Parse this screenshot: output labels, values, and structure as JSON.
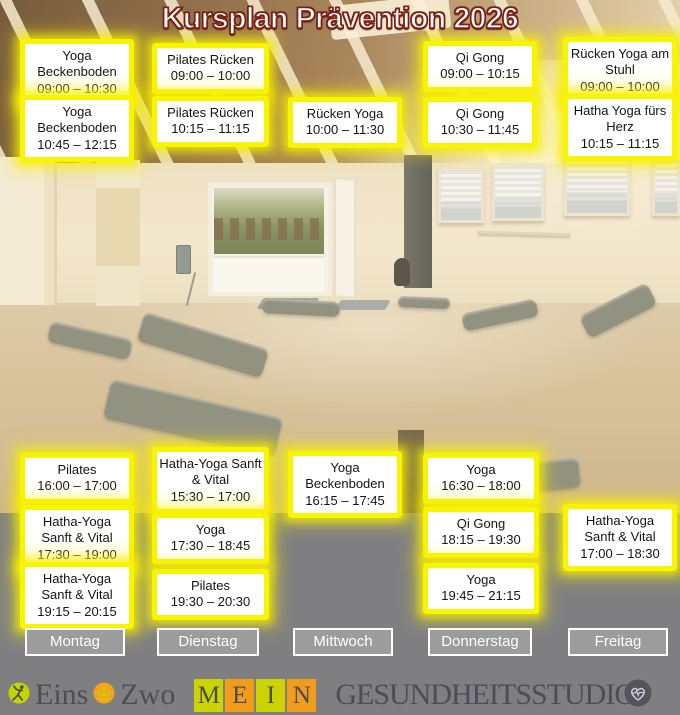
{
  "title": "Kursplan Prävention 2026",
  "days": [
    {
      "label": "Montag",
      "morning": [
        {
          "name": "Yoga Beckenboden",
          "time": "09:00 – 10:30"
        },
        {
          "name": "Yoga Beckenboden",
          "time": "10:45 – 12:15"
        }
      ],
      "evening": [
        {
          "name": "Pilates",
          "time": "16:00 – 17:00"
        },
        {
          "name": "Hatha-Yoga Sanft & Vital",
          "time": "17:30 – 19:00"
        },
        {
          "name": "Hatha-Yoga Sanft & Vital",
          "time": "19:15 – 20:15"
        }
      ]
    },
    {
      "label": "Dienstag",
      "morning": [
        {
          "name": "Pilates Rücken",
          "time": "09:00 – 10:00"
        },
        {
          "name": "Pilates Rücken",
          "time": "10:15 – 11:15"
        }
      ],
      "evening": [
        {
          "name": "Hatha-Yoga Sanft & Vital",
          "time": "15:30 – 17:00"
        },
        {
          "name": "Yoga",
          "time": "17:30 – 18:45"
        },
        {
          "name": "Pilates",
          "time": "19:30 – 20:30"
        }
      ]
    },
    {
      "label": "Mittwoch",
      "morning": [
        {
          "name": "Rücken Yoga",
          "time": "10:00 – 11:30"
        }
      ],
      "evening": [
        {
          "name": "Yoga Beckenboden",
          "time": "16:15 – 17:45"
        }
      ]
    },
    {
      "label": "Donnerstag",
      "morning": [
        {
          "name": "Qi Gong",
          "time": "09:00 – 10:15"
        },
        {
          "name": "Qi Gong",
          "time": "10:30 – 11:45"
        }
      ],
      "evening": [
        {
          "name": "Yoga",
          "time": "16:30 – 18:00"
        },
        {
          "name": "Qi Gong",
          "time": "18:15 – 19:30"
        },
        {
          "name": "Yoga",
          "time": "19:45 – 21:15"
        }
      ]
    },
    {
      "label": "Freitag",
      "morning": [
        {
          "name": "Rücken Yoga am Stuhl",
          "time": "09:00 – 10:00"
        },
        {
          "name": "Hatha Yoga fürs Herz",
          "time": "10:15 – 11:15"
        }
      ],
      "evening": [
        {
          "name": "Hatha-Yoga Sanft & Vital",
          "time": "17:00 – 18:30"
        }
      ]
    }
  ],
  "footer": {
    "brand_eins": "Eins",
    "brand_zwo": "Zwo",
    "mein": [
      "M",
      "E",
      "I",
      "N"
    ],
    "studio": "GESUNDHEITSSTUDIO",
    "icons": {
      "left": "dancer-pose-icon",
      "mid": "lotus-icon",
      "right": "heart-pulse-icon"
    }
  },
  "colors": {
    "card_glow": "#f8f500",
    "title_fill": "#ffffff",
    "title_outline": "#7b2015",
    "day_button_bg": "#9c9c9c",
    "band_gray": "#7f7f82",
    "tile_green": "#ccd400",
    "tile_orange": "#f19c1a",
    "footer_text": "#4d4d55"
  }
}
